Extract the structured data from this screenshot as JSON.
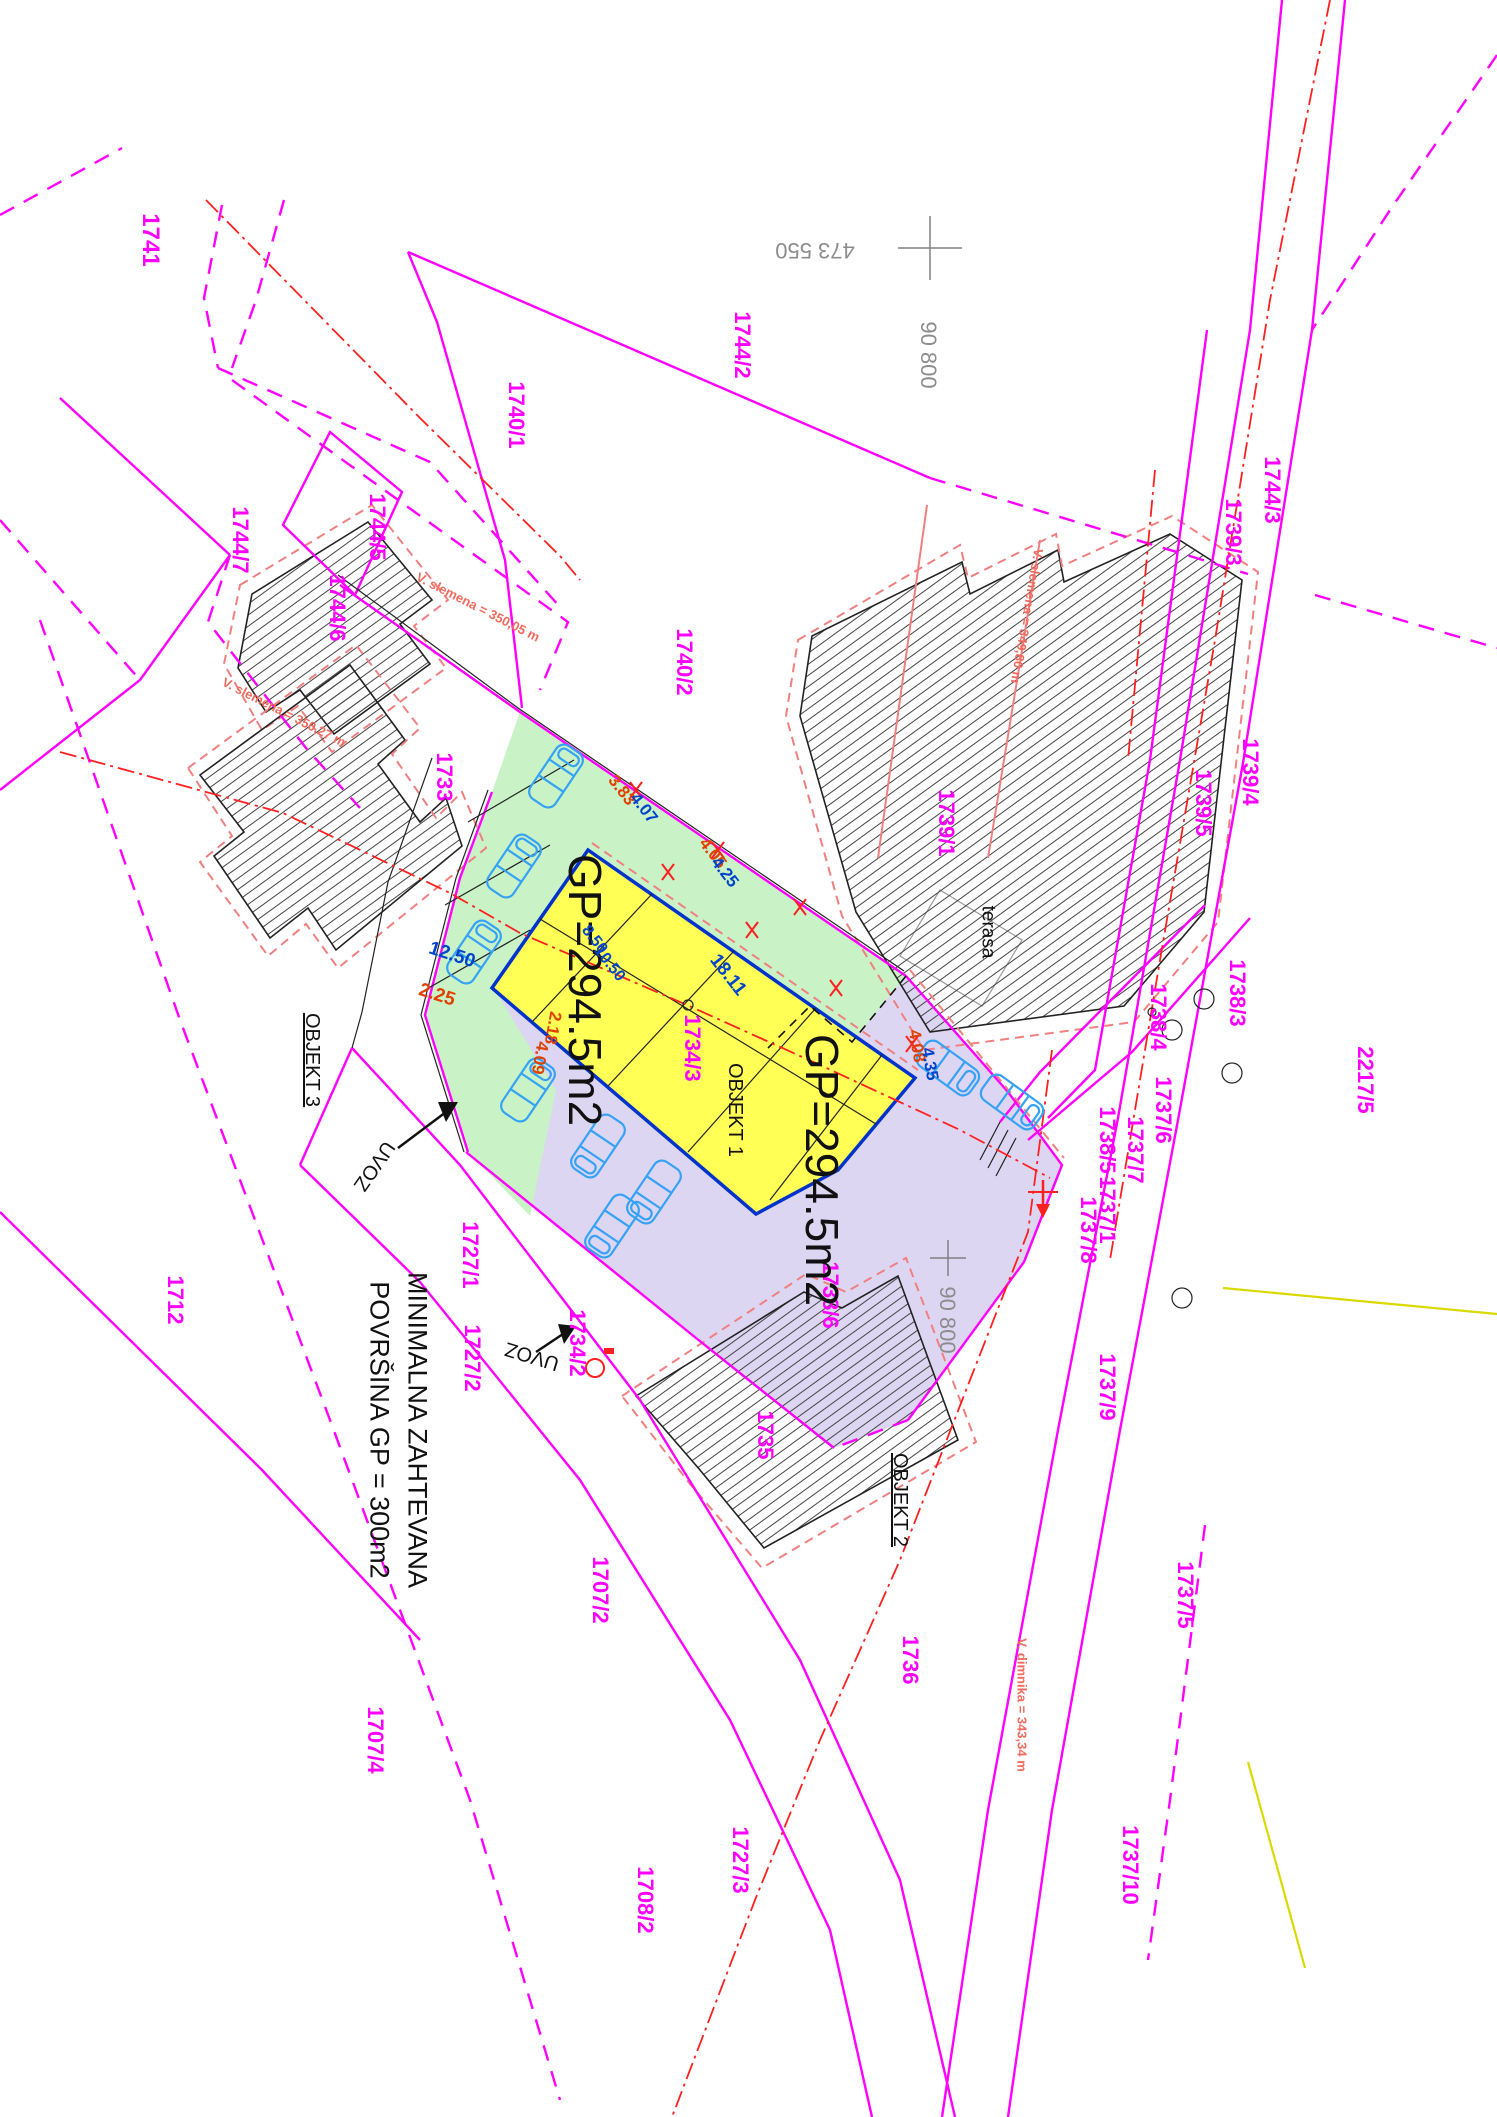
{
  "document_type": "site-plan",
  "colors": {
    "parcel_label": "#ff00ff",
    "dimension_blue": "#0044cc",
    "dimension_red": "#e04000",
    "coordinate_gray": "#8c8c8c",
    "annotation_salmon": "#f26a5e",
    "axis_red": "#ff2020",
    "utility_yellow": "#d9d900",
    "area_green": "#c9f2c6",
    "area_purple": "#dcd6f2",
    "building_yellow": "#ffff55",
    "building_edge_blue": "#0033cc"
  },
  "note": {
    "line1": "MINIMALNA ZAHTEVANA",
    "line2": "POVRŠINA GP = 300m2"
  },
  "buildings": {
    "proposed_area_label": "GP=294.5m2",
    "objekt1": "OBJEKT 1",
    "objekt2": "OBJEKT  2",
    "objekt3": "OBJEKT  3"
  },
  "labels": [
    {
      "id": "parcel-1741",
      "text": "1741",
      "x": 150,
      "y": 240,
      "rot": 90,
      "kind": "parcel",
      "size": 24
    },
    {
      "id": "parcel-1744-7",
      "text": "1744/7",
      "x": 240,
      "y": 540,
      "rot": 90,
      "kind": "parcel",
      "size": 22
    },
    {
      "id": "parcel-1744-5",
      "text": "1744/5",
      "x": 377,
      "y": 527,
      "rot": 90,
      "kind": "parcel",
      "size": 22
    },
    {
      "id": "parcel-1744-6",
      "text": "1744/6",
      "x": 337,
      "y": 608,
      "rot": 90,
      "kind": "parcel",
      "size": 22
    },
    {
      "id": "parcel-1740-1",
      "text": "1740/1",
      "x": 516,
      "y": 415,
      "rot": 90,
      "kind": "parcel",
      "size": 22
    },
    {
      "id": "parcel-1744-2",
      "text": "1744/2",
      "x": 742,
      "y": 345,
      "rot": 90,
      "kind": "parcel",
      "size": 22
    },
    {
      "id": "parcel-1740-2",
      "text": "1740/2",
      "x": 684,
      "y": 662,
      "rot": 90,
      "kind": "parcel",
      "size": 22
    },
    {
      "id": "parcel-1733",
      "text": "1733",
      "x": 444,
      "y": 777,
      "rot": 90,
      "kind": "parcel",
      "size": 22
    },
    {
      "id": "parcel-1739-1",
      "text": "1739/1",
      "x": 946,
      "y": 823,
      "rot": 90,
      "kind": "parcel",
      "size": 22
    },
    {
      "id": "parcel-1744-3",
      "text": "1744/3",
      "x": 1272,
      "y": 490,
      "rot": 90,
      "kind": "parcel",
      "size": 22
    },
    {
      "id": "parcel-1739-3",
      "text": "1739/3",
      "x": 1233,
      "y": 532,
      "rot": 90,
      "kind": "parcel",
      "size": 22
    },
    {
      "id": "parcel-1739-4",
      "text": "1739/4",
      "x": 1250,
      "y": 772,
      "rot": 90,
      "kind": "parcel",
      "size": 22
    },
    {
      "id": "parcel-1739-5",
      "text": "1739/5",
      "x": 1203,
      "y": 803,
      "rot": 90,
      "kind": "parcel",
      "size": 22
    },
    {
      "id": "parcel-1738-3",
      "text": "1738/3",
      "x": 1237,
      "y": 993,
      "rot": 90,
      "kind": "parcel",
      "size": 22
    },
    {
      "id": "parcel-1738-4",
      "text": "1738/4",
      "x": 1158,
      "y": 1017,
      "rot": 90,
      "kind": "parcel",
      "size": 22
    },
    {
      "id": "parcel-2217-5",
      "text": "2217/5",
      "x": 1365,
      "y": 1080,
      "rot": 90,
      "kind": "parcel",
      "size": 22
    },
    {
      "id": "parcel-1737-6",
      "text": "1737/6",
      "x": 1163,
      "y": 1110,
      "rot": 90,
      "kind": "parcel",
      "size": 22
    },
    {
      "id": "parcel-1738-5",
      "text": "1738/5",
      "x": 1107,
      "y": 1140,
      "rot": 90,
      "kind": "parcel",
      "size": 22
    },
    {
      "id": "parcel-1737-7",
      "text": "1737/7",
      "x": 1135,
      "y": 1150,
      "rot": 90,
      "kind": "parcel",
      "size": 22
    },
    {
      "id": "parcel-1737-1",
      "text": "1737/1",
      "x": 1107,
      "y": 1210,
      "rot": 90,
      "kind": "parcel",
      "size": 22
    },
    {
      "id": "parcel-1737-8",
      "text": "1737/8",
      "x": 1088,
      "y": 1230,
      "rot": 90,
      "kind": "parcel",
      "size": 22
    },
    {
      "id": "parcel-1737-9",
      "text": "1737/9",
      "x": 1107,
      "y": 1387,
      "rot": 90,
      "kind": "parcel",
      "size": 22
    },
    {
      "id": "parcel-1737-5",
      "text": "1737/5",
      "x": 1185,
      "y": 1595,
      "rot": 90,
      "kind": "parcel",
      "size": 22
    },
    {
      "id": "parcel-1737-10",
      "text": "1737/10",
      "x": 1130,
      "y": 1865,
      "rot": 90,
      "kind": "parcel",
      "size": 22
    },
    {
      "id": "parcel-1727-1",
      "text": "1727/1",
      "x": 470,
      "y": 1255,
      "rot": 90,
      "kind": "parcel",
      "size": 22
    },
    {
      "id": "parcel-1727-2",
      "text": "1727/2",
      "x": 472,
      "y": 1358,
      "rot": 90,
      "kind": "parcel",
      "size": 22
    },
    {
      "id": "parcel-1712",
      "text": "1712",
      "x": 175,
      "y": 1300,
      "rot": 90,
      "kind": "parcel",
      "size": 22
    },
    {
      "id": "parcel-1707-2",
      "text": "1707/2",
      "x": 600,
      "y": 1590,
      "rot": 90,
      "kind": "parcel",
      "size": 22
    },
    {
      "id": "parcel-1707-4",
      "text": "1707/4",
      "x": 375,
      "y": 1740,
      "rot": 90,
      "kind": "parcel",
      "size": 22
    },
    {
      "id": "parcel-1708-2",
      "text": "1708/2",
      "x": 645,
      "y": 1900,
      "rot": 90,
      "kind": "parcel",
      "size": 22
    },
    {
      "id": "parcel-1727-3",
      "text": "1727/3",
      "x": 740,
      "y": 1860,
      "rot": 90,
      "kind": "parcel",
      "size": 22
    },
    {
      "id": "parcel-1735",
      "text": "1735",
      "x": 765,
      "y": 1435,
      "rot": 90,
      "kind": "parcel",
      "size": 22
    },
    {
      "id": "parcel-1736",
      "text": "1736",
      "x": 910,
      "y": 1660,
      "rot": 90,
      "kind": "parcel",
      "size": 22
    },
    {
      "id": "parcel-1734-3",
      "text": "1734/3",
      "x": 692,
      "y": 1048,
      "rot": 90,
      "kind": "parcel",
      "size": 22
    },
    {
      "id": "parcel-1734-2",
      "text": "1734/2",
      "x": 577,
      "y": 1343,
      "rot": 90,
      "kind": "parcel",
      "size": 22
    },
    {
      "id": "parcel-1738-6",
      "text": "1738/6",
      "x": 830,
      "y": 1295,
      "rot": 90,
      "kind": "parcel",
      "size": 22
    },
    {
      "id": "coord-473550",
      "text": "473 550",
      "x": 815,
      "y": 250,
      "rot": 180,
      "kind": "coord",
      "size": 22
    },
    {
      "id": "coord-90800-top",
      "text": "90 800",
      "x": 928,
      "y": 355,
      "rot": 90,
      "kind": "coord",
      "size": 22
    },
    {
      "id": "coord-90800-bottom",
      "text": "90 800",
      "x": 947,
      "y": 1320,
      "rot": 90,
      "kind": "coord",
      "size": 22
    },
    {
      "id": "objekt-1",
      "text": "OBJEKT 1",
      "x": 735,
      "y": 1110,
      "rot": 90,
      "kind": "note",
      "size": 20
    },
    {
      "id": "objekt-2",
      "text": "OBJEKT  2",
      "x": 900,
      "y": 1500,
      "rot": 90,
      "kind": "note",
      "size": 20,
      "underline": true
    },
    {
      "id": "objekt-3",
      "text": "OBJEKT  3",
      "x": 312,
      "y": 1060,
      "rot": 90,
      "kind": "note",
      "size": 20,
      "underline": true
    },
    {
      "id": "gp-area-1",
      "text": "GP=294.5m2",
      "x": 585,
      "y": 990,
      "rot": 90,
      "kind": "gp",
      "size": 46
    },
    {
      "id": "gp-area-2",
      "text": "GP=294.5m2",
      "x": 822,
      "y": 1170,
      "rot": 90,
      "kind": "gp",
      "size": 46
    },
    {
      "id": "note-line1",
      "text": "MINIMALNA ZAHTEVANA",
      "x": 417,
      "y": 1430,
      "rot": 90,
      "kind": "note",
      "size": 27
    },
    {
      "id": "note-line2",
      "text": "POVRŠINA GP = 300m2",
      "x": 379,
      "y": 1430,
      "rot": 90,
      "kind": "note",
      "size": 27
    },
    {
      "id": "uvoz-1",
      "text": "UVOZ",
      "x": 374,
      "y": 1166,
      "rot": 125,
      "kind": "note",
      "size": 20
    },
    {
      "id": "uvoz-2",
      "text": "UVOZ",
      "x": 532,
      "y": 1356,
      "rot": 197,
      "kind": "note",
      "size": 20
    },
    {
      "id": "terasa",
      "text": "terasa",
      "x": 988,
      "y": 932,
      "rot": 90,
      "kind": "note",
      "size": 19
    },
    {
      "id": "dim-3-83",
      "text": "3.83",
      "x": 622,
      "y": 790,
      "rot": 52,
      "kind": "dim_r",
      "size": 17
    },
    {
      "id": "dim-4-07",
      "text": "4.07",
      "x": 644,
      "y": 808,
      "rot": 52,
      "kind": "dim_b",
      "size": 17
    },
    {
      "id": "dim-4-05",
      "text": "4.05",
      "x": 713,
      "y": 853,
      "rot": 52,
      "kind": "dim_r",
      "size": 17
    },
    {
      "id": "dim-4-25",
      "text": "4.25",
      "x": 725,
      "y": 872,
      "rot": 52,
      "kind": "dim_b",
      "size": 17
    },
    {
      "id": "dim-12-50",
      "text": "12.50",
      "x": 452,
      "y": 955,
      "rot": 18,
      "kind": "dim_b",
      "size": 19
    },
    {
      "id": "dim-2-25",
      "text": "2.25",
      "x": 437,
      "y": 995,
      "rot": 18,
      "kind": "dim_r",
      "size": 19
    },
    {
      "id": "dim-8-50",
      "text": "8.50",
      "x": 594,
      "y": 940,
      "rot": 52,
      "kind": "dim_b",
      "size": 16
    },
    {
      "id": "dim-10-50",
      "text": "10.50",
      "x": 609,
      "y": 964,
      "rot": 52,
      "kind": "dim_b",
      "size": 16
    },
    {
      "id": "dim-18-11",
      "text": "18.11",
      "x": 728,
      "y": 975,
      "rot": 52,
      "kind": "dim_b",
      "size": 19
    },
    {
      "id": "dim-2-18",
      "text": "2.18",
      "x": 553,
      "y": 1028,
      "rot": 100,
      "kind": "dim_r",
      "size": 17
    },
    {
      "id": "dim-4-09",
      "text": "4.09",
      "x": 540,
      "y": 1058,
      "rot": 100,
      "kind": "dim_r",
      "size": 17
    },
    {
      "id": "dim-4-08",
      "text": "4.08",
      "x": 917,
      "y": 1046,
      "rot": 80,
      "kind": "dim_r",
      "size": 17
    },
    {
      "id": "dim-4-35",
      "text": "4.35",
      "x": 930,
      "y": 1064,
      "rot": 80,
      "kind": "dim_b",
      "size": 17
    },
    {
      "id": "ann-ridge-1",
      "text": "V. slemena  =  350,05 m",
      "x": 478,
      "y": 607,
      "rot": 27,
      "kind": "ann",
      "size": 13
    },
    {
      "id": "ann-ridge-2",
      "text": "V. slemena  =  350,27 m",
      "x": 284,
      "y": 712,
      "rot": 27,
      "kind": "ann",
      "size": 13
    },
    {
      "id": "ann-ridge-3",
      "text": "V. slemena  =  349,80 m",
      "x": 1027,
      "y": 616,
      "rot": 100,
      "kind": "ann",
      "size": 13
    },
    {
      "id": "ann-chimney",
      "text": "V. dimnika  =  343,34 m",
      "x": 1022,
      "y": 1705,
      "rot": 90,
      "kind": "ann",
      "size": 13
    }
  ]
}
